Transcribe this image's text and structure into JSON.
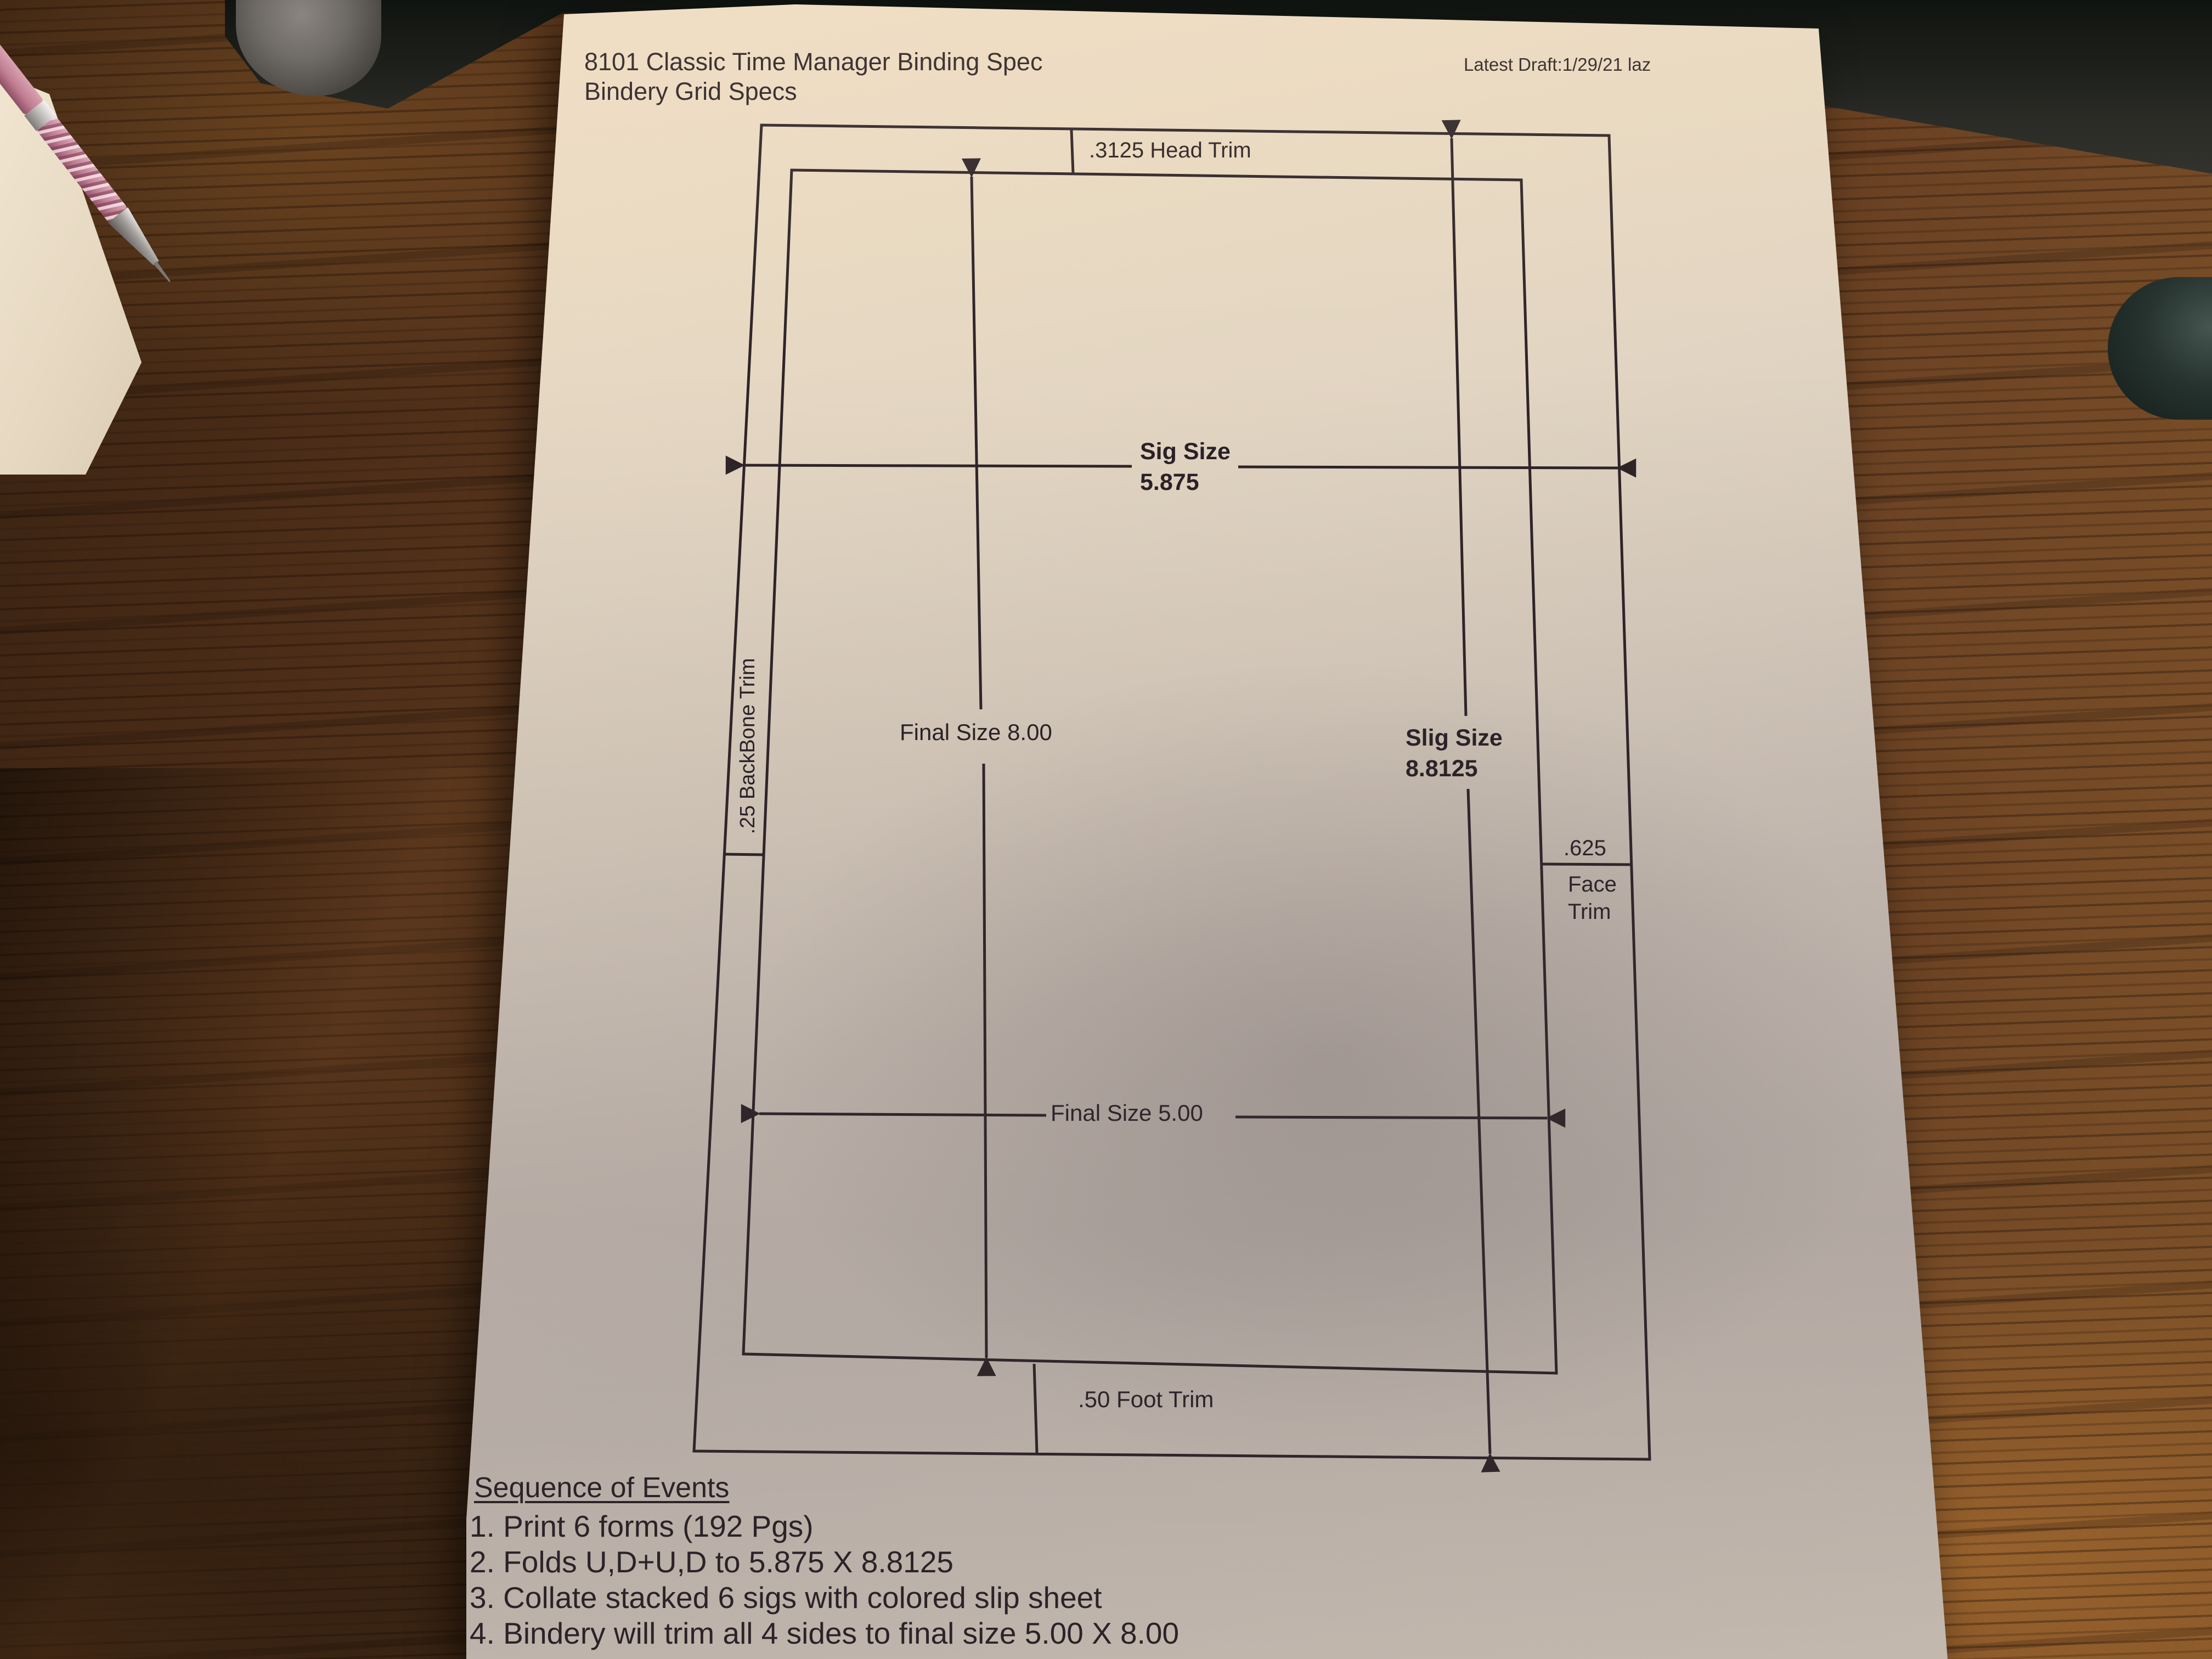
{
  "document": {
    "title_line1": "8101 Classic Time Manager Binding Spec",
    "title_line2": "Bindery Grid Specs",
    "draft_note": "Latest Draft:1/29/21 laz"
  },
  "diagram": {
    "head_trim_label": ".3125 Head Trim",
    "sig_size": {
      "label": "Sig Size",
      "value": "5.875"
    },
    "final_height_label": "Final Size 8.00",
    "slig_size": {
      "label": "Slig Size",
      "value": "8.8125"
    },
    "face_trim": {
      "value": ".625",
      "line1": "Face",
      "line2": "Trim"
    },
    "backbone_label": ".25 BackBone Trim",
    "final_width_label": "Final Size 5.00",
    "foot_trim_label": ".50 Foot Trim"
  },
  "sequence": {
    "heading": "Sequence of Events",
    "items": [
      "1. Print 6 forms (192 Pgs)",
      "2. Folds U,D+U,D to 5.875 X 8.8125",
      "3. Collate stacked 6 sigs with colored slip sheet",
      "4. Bindery will trim all 4 sides to final size 5.00 X 8.00"
    ]
  },
  "colors": {
    "paper": "#e2d5c2",
    "ink": "#2e2428",
    "wood": "#5a3317",
    "device_bar": "#2a2b26",
    "pen_pink": "#c07e93"
  }
}
